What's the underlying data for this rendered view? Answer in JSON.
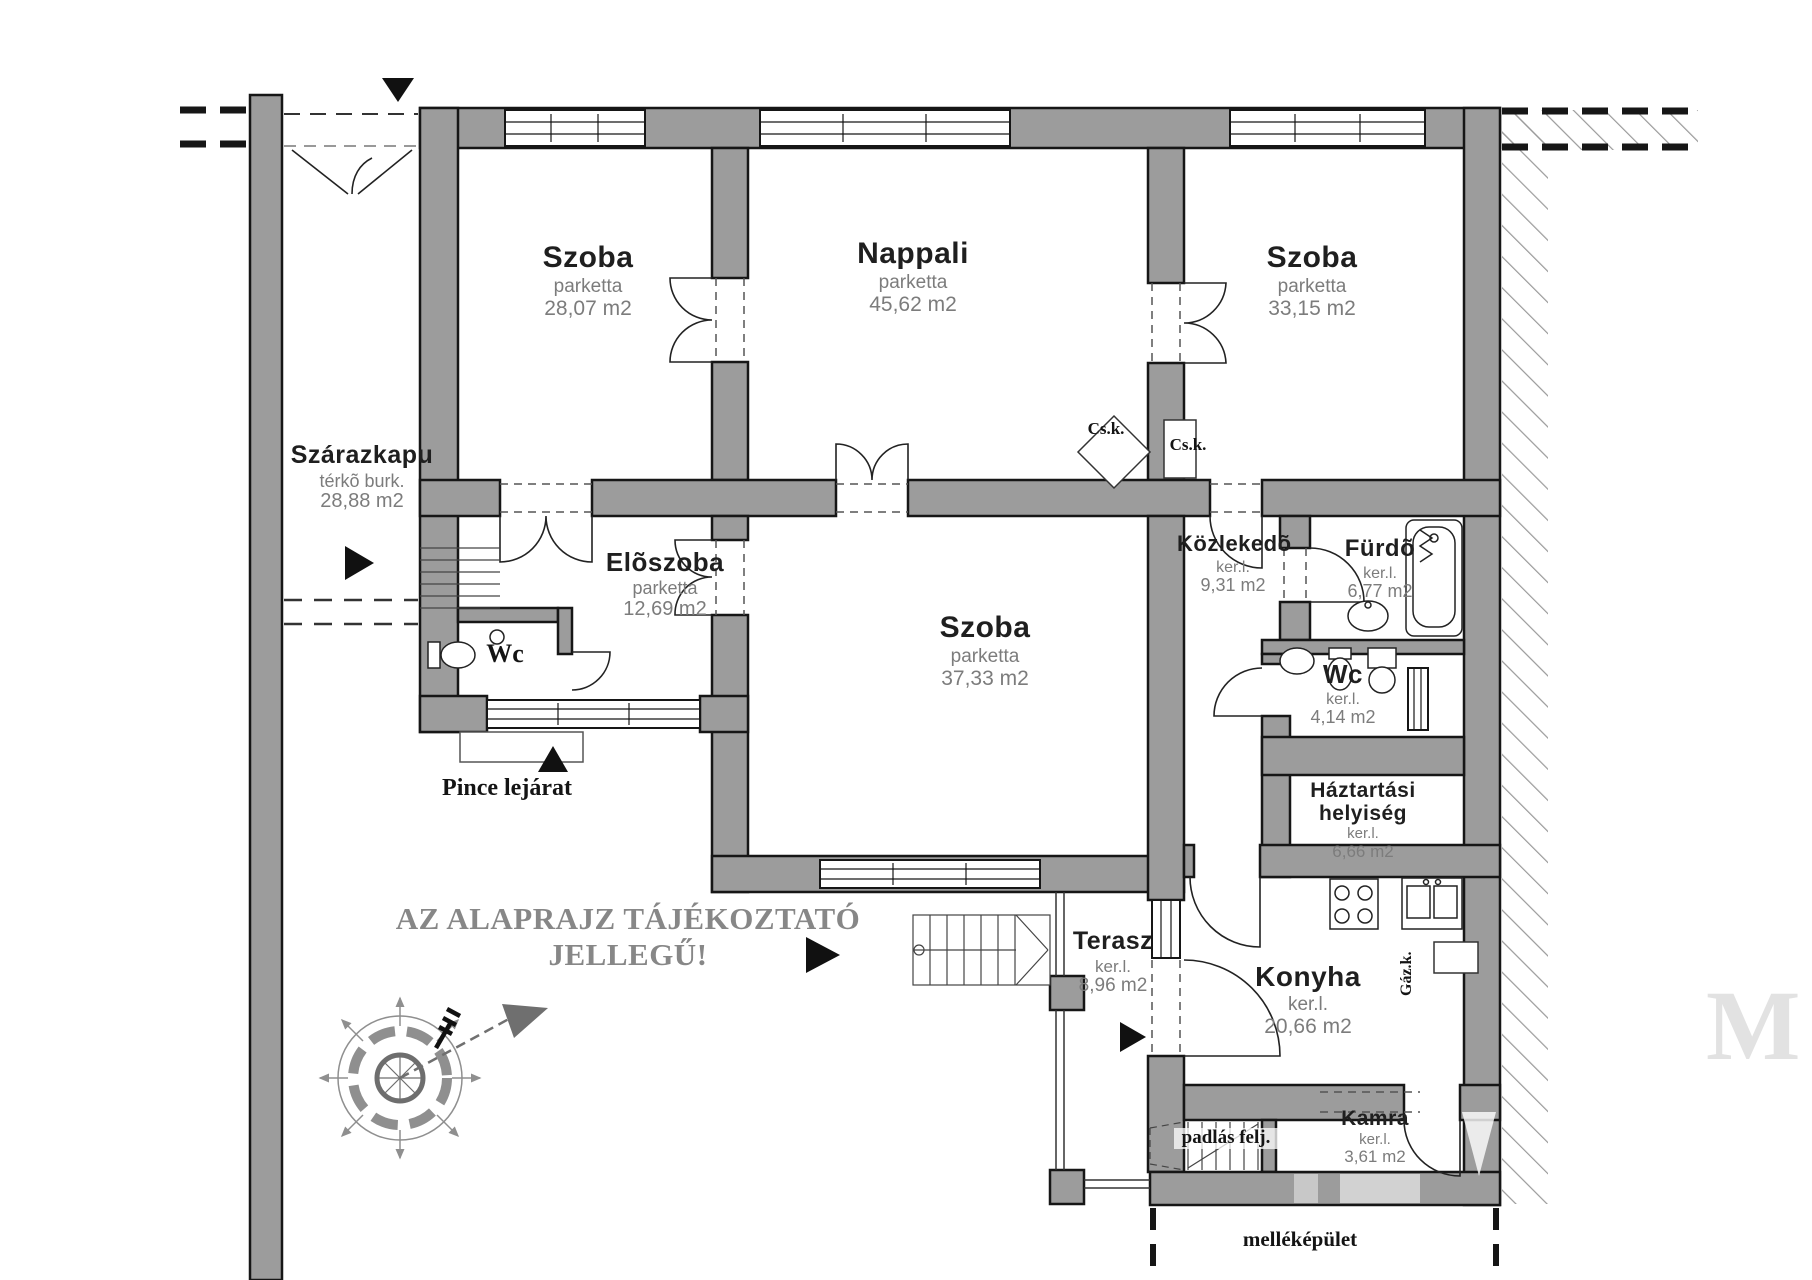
{
  "disclaimer": "AZ ALAPRAJZ TÁJÉKOZTATÓ JELLEGŰ!",
  "rooms": [
    {
      "name": "Szoba",
      "floor": "parketta",
      "area": "28,07 m2"
    },
    {
      "name": "Nappali",
      "floor": "parketta",
      "area": "45,62 m2"
    },
    {
      "name": "Szoba",
      "floor": "parketta",
      "area": "33,15 m2"
    },
    {
      "name": "Szárazkapu",
      "floor": "térkõ burk.",
      "area": "28,88 m2"
    },
    {
      "name": "Elõszoba",
      "floor": "parketta",
      "area": "12,69 m2"
    },
    {
      "name": "Wc"
    },
    {
      "name": "Szoba",
      "floor": "parketta",
      "area": "37,33 m2"
    },
    {
      "name": "Közlekedõ",
      "floor": "ker.l.",
      "area": "9,31 m2"
    },
    {
      "name": "Fürdõ",
      "floor": "ker.l.",
      "area": "6,77 m2"
    },
    {
      "name": "Wc",
      "floor": "ker.l.",
      "area": "4,14 m2"
    },
    {
      "name": "Háztartási helyiség",
      "floor": "ker.l.",
      "area": "6,66 m2"
    },
    {
      "name": "Terasz",
      "floor": "ker.l.",
      "area": "8,96 m2"
    },
    {
      "name": "Konyha",
      "floor": "ker.l.",
      "area": "20,66 m2"
    },
    {
      "name": "Kamra",
      "floor": "ker.l.",
      "area": "3,61 m2"
    }
  ],
  "annotations": {
    "pince_lejarat": "Pince lejárat",
    "padlas_felj": "padlás felj.",
    "mellekepulet": "melléképület",
    "csk": "Cs.k.",
    "gazk": "Gáz.k.",
    "watermark": "M"
  },
  "icons": {
    "compass": "compass-rose",
    "north_arrow": "north-arrow",
    "entrance_marker": "triangle-marker"
  },
  "colors": {
    "wall_fill": "#9c9c9c",
    "outline": "#161616",
    "sublabel_text": "#7c7c7c",
    "disclaimer_text": "#878787",
    "hatch_line": "#9a9a9a"
  }
}
